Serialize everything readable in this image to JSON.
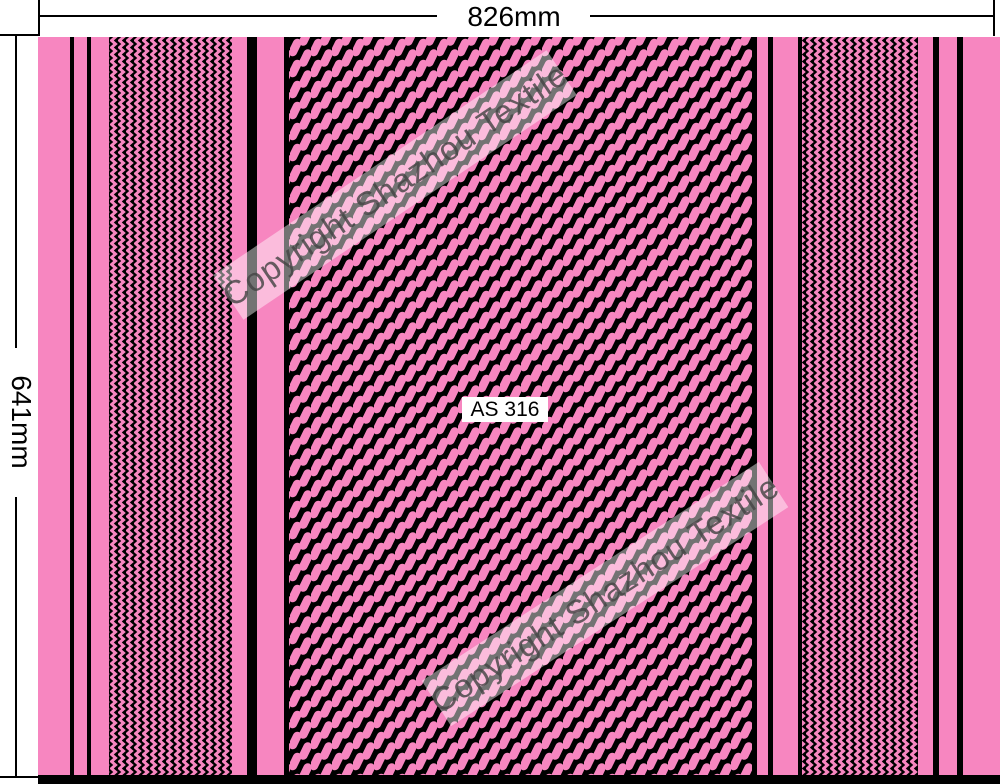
{
  "annotations": {
    "width_label": "826mm",
    "height_label": "641mm"
  },
  "label": {
    "text": "AS 316"
  },
  "watermark": {
    "text": "Copyright Shazhou Textile"
  },
  "colors": {
    "pink": "#F786C0",
    "black": "#000000",
    "white": "#FFFFFF",
    "watermark_band": "rgba(255,255,255,0.45)",
    "watermark_text": "rgba(68,68,68,0.82)"
  },
  "fabric": {
    "height": 747,
    "stripes": [
      {
        "type": "pink",
        "x": 0,
        "w": 32
      },
      {
        "type": "black",
        "x": 32,
        "w": 4
      },
      {
        "type": "pink",
        "x": 36,
        "w": 13
      },
      {
        "type": "black",
        "x": 49,
        "w": 4
      },
      {
        "type": "pink",
        "x": 53,
        "w": 18
      },
      {
        "type": "zz",
        "x": 71,
        "w": 123
      },
      {
        "type": "pink",
        "x": 194,
        "w": 15
      },
      {
        "type": "black",
        "x": 209,
        "w": 10
      },
      {
        "type": "pink",
        "x": 219,
        "w": 27
      },
      {
        "type": "black",
        "x": 246,
        "w": 5
      },
      {
        "type": "wv",
        "x": 251,
        "w": 463
      },
      {
        "type": "black",
        "x": 714,
        "w": 5
      },
      {
        "type": "pink",
        "x": 719,
        "w": 11
      },
      {
        "type": "black",
        "x": 730,
        "w": 5
      },
      {
        "type": "pink",
        "x": 735,
        "w": 25
      },
      {
        "type": "black",
        "x": 760,
        "w": 4
      },
      {
        "type": "zz",
        "x": 764,
        "w": 116
      },
      {
        "type": "pink",
        "x": 880,
        "w": 15
      },
      {
        "type": "black",
        "x": 895,
        "w": 6
      },
      {
        "type": "pink",
        "x": 901,
        "w": 18
      },
      {
        "type": "black",
        "x": 919,
        "w": 6
      },
      {
        "type": "pink",
        "x": 925,
        "w": 37
      }
    ],
    "bottom_bar": {
      "x": 0,
      "y": 738,
      "w": 962,
      "h": 9
    }
  }
}
